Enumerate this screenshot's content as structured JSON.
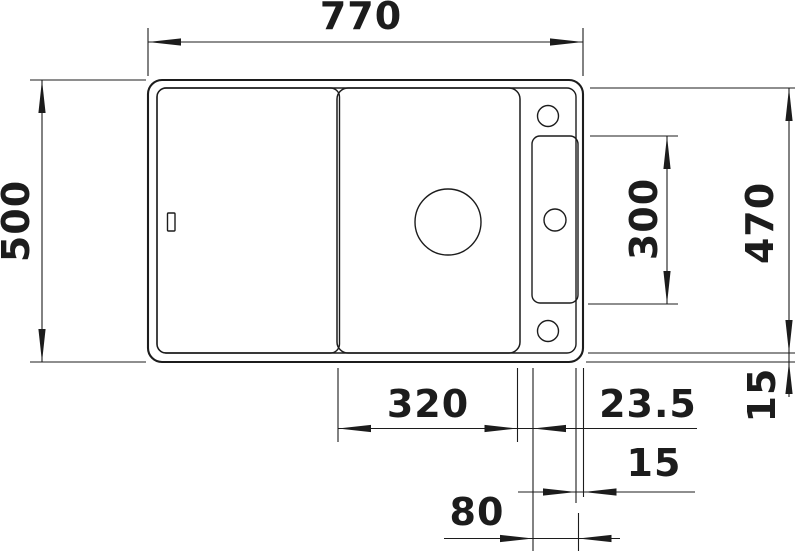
{
  "drawing": {
    "type": "sink-top-view-dimension-drawing",
    "units_note": "",
    "colors": {
      "line": "#1c1c1c",
      "background": "#ffffff"
    }
  },
  "dimensions": {
    "overall_width": "770",
    "overall_depth": "500",
    "tap_panel_length": "300",
    "inner_depth": "470",
    "bowl_width": "320",
    "bowl_to_tap_panel": "23.5",
    "rim_edge_right": "15",
    "panel_to_edge": "15",
    "tap_panel_width": "80"
  }
}
